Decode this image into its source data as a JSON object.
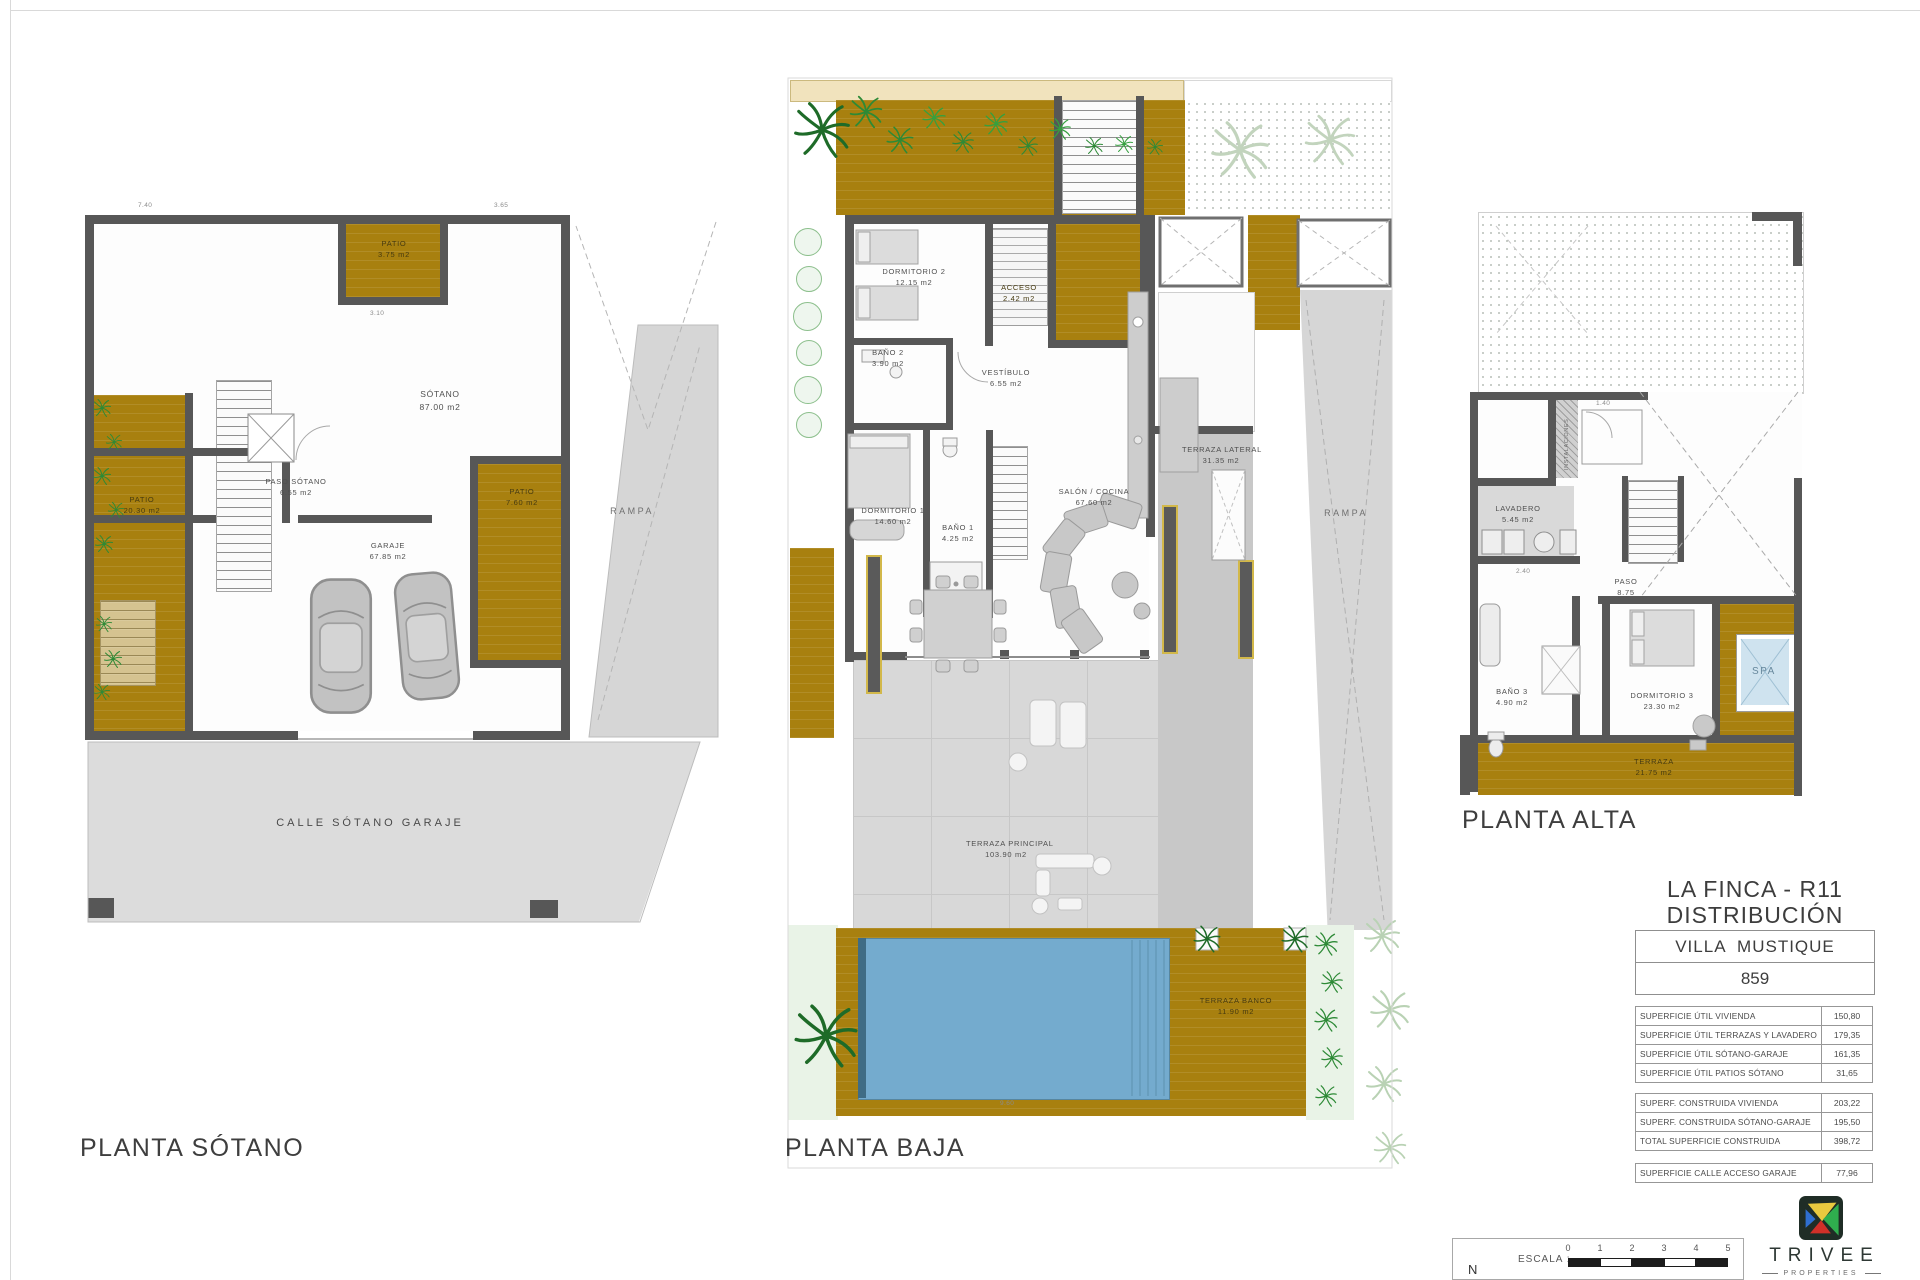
{
  "plans": {
    "sotano": {
      "label": "PLANTA SÓTANO",
      "rooms": [
        {
          "name": "PATIO",
          "area": "3.75 m2"
        },
        {
          "name": "SÓTANO",
          "area": "87.00 m2"
        },
        {
          "name": "PASO SÓTANO",
          "area": "6.55 m2"
        },
        {
          "name": "PATIO",
          "area": "20.30 m2"
        },
        {
          "name": "PATIO",
          "area": "7.60 m2"
        },
        {
          "name": "GARAJE",
          "area": "67.85 m2"
        },
        {
          "name": "RAMPA",
          "area": ""
        },
        {
          "name": "CALLE SÓTANO GARAJE",
          "area": ""
        }
      ]
    },
    "baja": {
      "label": "PLANTA BAJA",
      "rooms": [
        {
          "name": "DORMITORIO 2",
          "area": "12.15 m2"
        },
        {
          "name": "BAÑO 2",
          "area": "3.90 m2"
        },
        {
          "name": "ACCESO",
          "area": "2.42 m2"
        },
        {
          "name": "VESTÍBULO",
          "area": "6.55 m2"
        },
        {
          "name": "DORMITORIO 1",
          "area": "14.60 m2"
        },
        {
          "name": "BAÑO 1",
          "area": "4.25 m2"
        },
        {
          "name": "SALÓN / COCINA",
          "area": "67.60 m2"
        },
        {
          "name": "TERRAZA LATERAL",
          "area": "31.35 m2"
        },
        {
          "name": "RAMPA",
          "area": ""
        },
        {
          "name": "TERRAZA PRINCIPAL",
          "area": "103.90 m2"
        },
        {
          "name": "TERRAZA BANCO",
          "area": "11.90 m2"
        }
      ]
    },
    "alta": {
      "label": "PLANTA ALTA",
      "rooms": [
        {
          "name": "INSTALACIONES",
          "area": ""
        },
        {
          "name": "LAVADERO",
          "area": "5.45 m2"
        },
        {
          "name": "PASO",
          "area": "8.75"
        },
        {
          "name": "BAÑO 3",
          "area": "4.90 m2"
        },
        {
          "name": "DORMITORIO 3",
          "area": "23.30 m2"
        },
        {
          "name": "SPA",
          "area": ""
        },
        {
          "name": "TERRAZA",
          "area": "21.75 m2"
        }
      ]
    }
  },
  "title_block": {
    "project": "LA FINCA - R11",
    "sheet": "DISTRIBUCIÓN",
    "villa": "VILLA  MUSTIQUE",
    "number": "859"
  },
  "summary": {
    "util": [
      {
        "label": "SUPERFICIE ÚTIL VIVIENDA",
        "value": "150,80"
      },
      {
        "label": "SUPERFICIE ÚTIL TERRAZAS Y LAVADERO",
        "value": "179,35"
      },
      {
        "label": "SUPERFICIE ÚTIL SÓTANO-GARAJE",
        "value": "161,35"
      },
      {
        "label": "SUPERFICIE ÚTIL PATIOS SÓTANO",
        "value": "31,65"
      }
    ],
    "construida": [
      {
        "label": "SUPERF. CONSTRUIDA VIVIENDA",
        "value": "203,22"
      },
      {
        "label": "SUPERF. CONSTRUIDA SÓTANO-GARAJE",
        "value": "195,50"
      },
      {
        "label": "TOTAL SUPERFICIE CONSTRUIDA",
        "value": "398,72"
      }
    ],
    "calle": [
      {
        "label": "SUPERFICIE CALLE ACCESO GARAJE",
        "value": "77,96"
      }
    ]
  },
  "dimensions": [
    "7.40",
    "3.65",
    "3.10",
    "9.60",
    "1.40",
    "2.40"
  ],
  "footer": {
    "north": "N",
    "scale_label": "ESCALA :",
    "ticks": [
      "0",
      "1",
      "2",
      "3",
      "4",
      "5"
    ],
    "brand": "TRIVEE",
    "brand_sub": "PROPERTIES"
  },
  "colors": {
    "ochre": "#A8800F",
    "wall": "#575757",
    "pool": "#74ABCE",
    "spa_fill": "#CFE3EF",
    "plan_gray": "#D8D8D8",
    "green": "#2F8F3A",
    "logo_yellow": "#E9C93F",
    "logo_green": "#2FAE4E",
    "logo_red": "#D03028",
    "logo_blue": "#2F6FD0"
  }
}
